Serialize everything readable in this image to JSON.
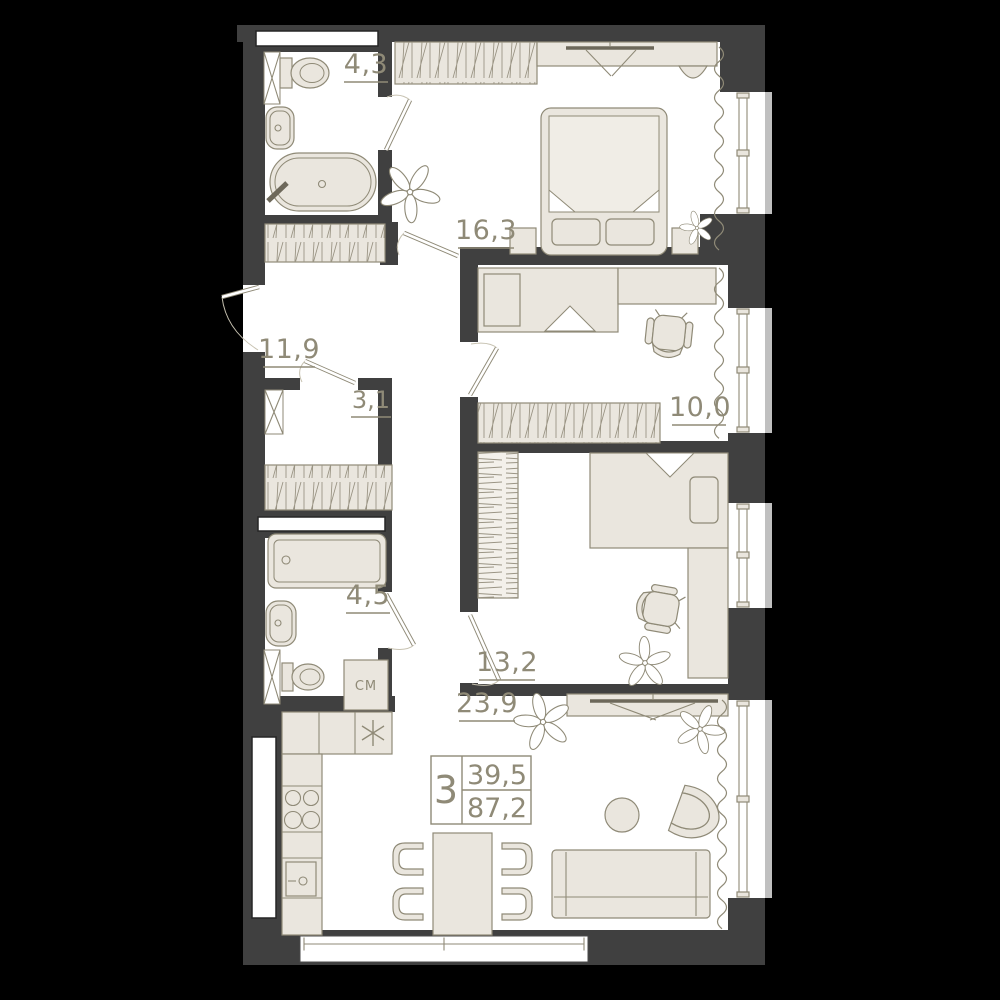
{
  "rooms": [
    {
      "name": "bathroom-top",
      "area_label": "4,3"
    },
    {
      "name": "bedroom-master",
      "area_label": "16,3"
    },
    {
      "name": "hallway",
      "area_label": "11,9"
    },
    {
      "name": "storage",
      "area_label": "3,1"
    },
    {
      "name": "bedroom-child",
      "area_label": "10,0"
    },
    {
      "name": "bathroom-bottom",
      "area_label": "4,5"
    },
    {
      "name": "bedroom-second",
      "area_label": "13,2"
    },
    {
      "name": "kitchen-living",
      "area_label": "23,9"
    }
  ],
  "labels": {
    "washing_machine": "СМ"
  },
  "summary": {
    "rooms_count": "3",
    "living_area": "39,5",
    "total_area": "87,2"
  },
  "colors": {
    "background": "#000000",
    "walls": "#404040",
    "floor": "#ffffff",
    "furniture_fill": "#eae6de",
    "outline": "#8f8a77",
    "window_sill": "#c0c0c0"
  }
}
